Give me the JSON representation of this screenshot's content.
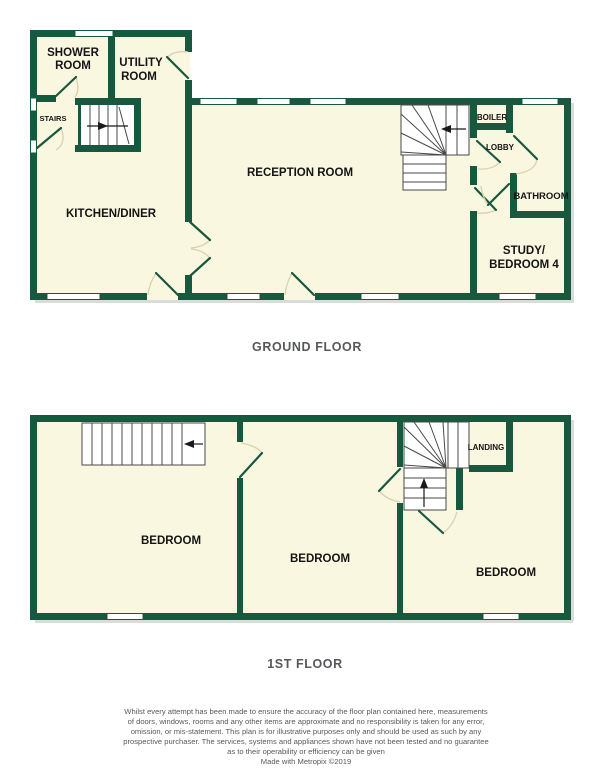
{
  "ground_floor": {
    "label": "GROUND FLOOR",
    "rooms": {
      "shower": [
        "SHOWER",
        "ROOM"
      ],
      "utility": [
        "UTILITY",
        "ROOM"
      ],
      "stairs": "STAIRS",
      "kitchen": "KITCHEN/DINER",
      "reception": "RECEPTION ROOM",
      "boiler": "BOILER",
      "lobby": "LOBBY",
      "bathroom": "BATHROOM",
      "study": [
        "STUDY/",
        "BEDROOM 4"
      ]
    }
  },
  "first_floor": {
    "label": "1ST FLOOR",
    "rooms": {
      "bedroom_left": "BEDROOM",
      "bedroom_middle": "BEDROOM",
      "bedroom_right": "BEDROOM",
      "landing": "LANDING"
    }
  },
  "disclaimer": {
    "lines": [
      "Whilst every attempt has been made to ensure the accuracy of the floor plan contained here, measurements",
      "of doors, windows, rooms and any other items are approximate and no responsibility is taken for any error,",
      "omission, or mis-statement. This plan is for illustrative purposes only and should be used as such by any",
      "prospective purchaser. The services, systems and appliances shown have not been tested and no guarantee",
      "as to their operability or efficiency can be given"
    ],
    "credit": "Made with Metropix ©2019"
  },
  "colors": {
    "wall_green": "#17583E",
    "floor_cream": "#FAF7E0",
    "label_black": "#141414",
    "muted_gray": "#58595B"
  }
}
